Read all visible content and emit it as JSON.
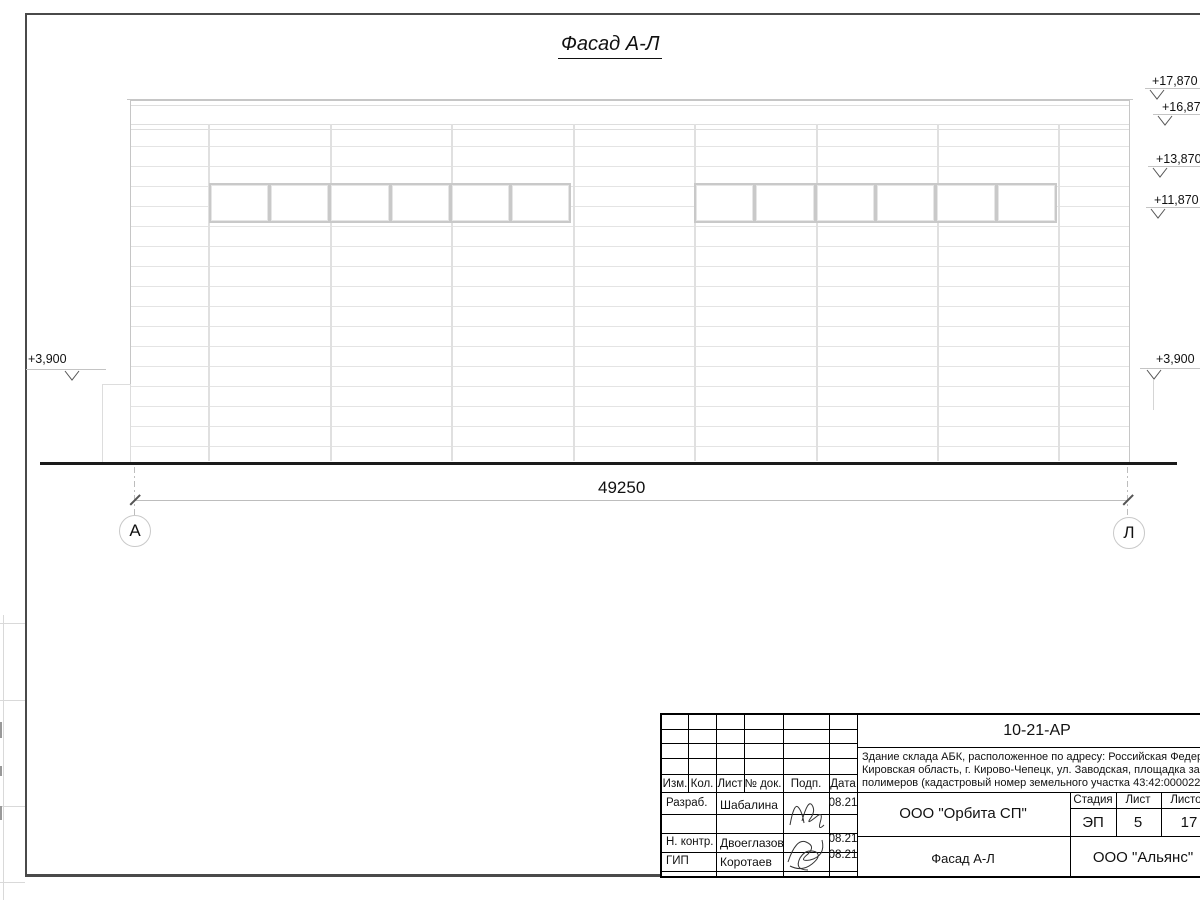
{
  "colors": {
    "frame": "#4a4a4a",
    "ground_line": "#1a1a1a",
    "drawing_line": "#d9d9d9",
    "text": "#111111"
  },
  "drawing": {
    "title": "Фасад А-Л",
    "axis_left": "А",
    "axis_right": "Л",
    "dimension_total": "49250",
    "elevation_left": "+3,900",
    "elevations_right": [
      "+17,870",
      "+16,870",
      "+13,870",
      "+11,870",
      "+3,900"
    ]
  },
  "title_block": {
    "doc_number": "10-21-АР",
    "description_lines": [
      "Здание склада АБК, расположенное по адресу: Российская Федерация,",
      "Кировская область, г. Кирово-Чепецк, ул. Заводская, площадка завода",
      "полимеров (кадастровый номер земельного участка 43:42:000022:"
    ],
    "columns": {
      "izm": "Изм.",
      "kol": "Кол.",
      "list": "Лист",
      "doc": "№ док.",
      "podp": "Подп.",
      "data": "Дата"
    },
    "roles": {
      "r1": "Разраб.",
      "r2": "Н. контр.",
      "r3": "ГИП"
    },
    "names": {
      "n1": "Шабалина",
      "n2": "Двоеглазов",
      "n3": "Коротаев"
    },
    "dates": {
      "d1": "08.21",
      "d2": "08.21",
      "d3": "08.21"
    },
    "org": "ООО \"Орбита СП\"",
    "stage_label": "Стадия",
    "sheet_label": "Лист",
    "sheets_label": "Листов",
    "stage": "ЭП",
    "sheet_num": "5",
    "sheets_total": "17",
    "view_title": "Фасад А-Л",
    "company": "ООО \"Альянс\""
  }
}
